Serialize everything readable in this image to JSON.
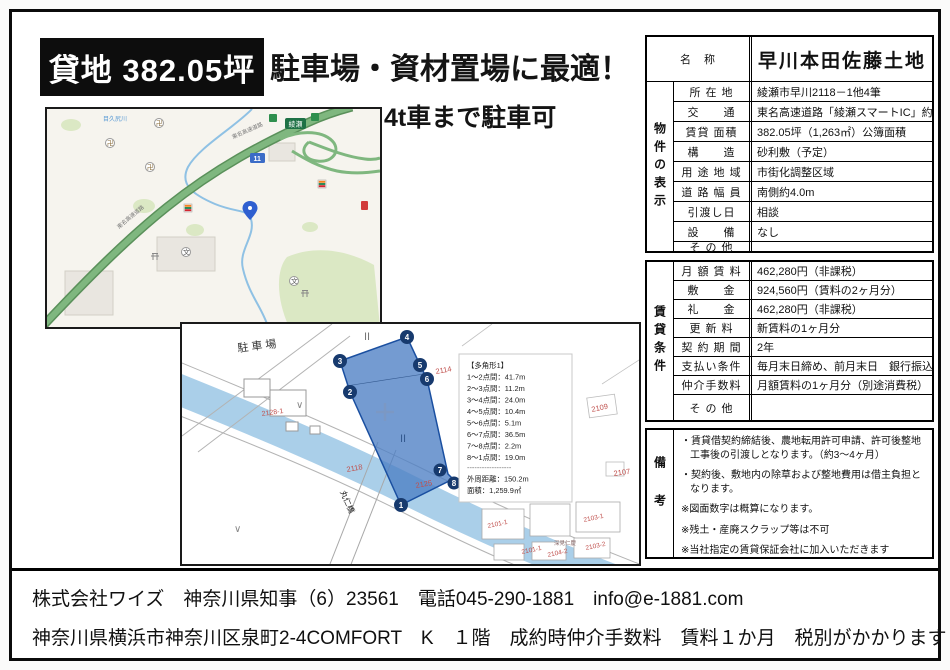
{
  "header": {
    "badge": "貸地 382.05坪",
    "headline": "駐車場・資材置場に最適！",
    "sub_headline": "4t車まで駐車可"
  },
  "property_table": {
    "name_label": "名　称",
    "name_value": "早川本田佐藤土地",
    "display": {
      "section_label": "物件の表示",
      "rows": [
        {
          "label": "所 在 地",
          "value": "綾瀬市早川2118－1他4筆"
        },
        {
          "label": "交　　通",
          "value": "東名高速道路「綾瀬スマートIC」約1km"
        },
        {
          "label": "賃貸 面積",
          "value": "382.05坪（1,263㎡）公簿面積"
        },
        {
          "label": "構　　造",
          "value": "砂利敷（予定）"
        },
        {
          "label": "用 途 地 域",
          "value": "市街化調整区域"
        },
        {
          "label": "道 路 幅 員",
          "value": "南側約4.0m"
        },
        {
          "label": "引渡し日",
          "value": "相談"
        },
        {
          "label": "設　　備",
          "value": "なし"
        },
        {
          "label": "そ の 他",
          "value": ""
        }
      ]
    },
    "lease": {
      "section_label": "賃貸条件",
      "rows": [
        {
          "label": "月 額 賃 料",
          "value": "462,280円（非課税）"
        },
        {
          "label": "敷　　金",
          "value": "924,560円（賃料の2ヶ月分）"
        },
        {
          "label": "礼　　金",
          "value": "462,280円（非課税）"
        },
        {
          "label": "更 新 料",
          "value": "新賃料の1ヶ月分"
        },
        {
          "label": "契 約 期 間",
          "value": "2年"
        },
        {
          "label": "支払い条件",
          "value": "毎月末日締め、前月末日　銀行振込"
        },
        {
          "label": "仲介手数料",
          "value": "月額賃料の1ヶ月分（別途消費税）"
        },
        {
          "label": "そ の 他",
          "value": ""
        }
      ]
    },
    "remarks": {
      "section_label": "備考",
      "items": [
        "・賃貸借契約締結後、農地転用許可申請、許可後整地工事後の引渡しとなります。（約3～4ヶ月）",
        "・契約後、敷地内の除草および整地費用は借主負担となります。",
        "※図面数字は概算になります。",
        "※残土・産廃スクラップ等は不可",
        "※当社指定の賃貸保証会社に加入いただきます"
      ]
    }
  },
  "road_map": {
    "expressway_label": "東名高速道路",
    "river_label": "目久尻川",
    "ic_sign_label": "綾瀬",
    "route_shield": "11",
    "temple_glyph": "卍",
    "school_glyph": "文"
  },
  "site_map": {
    "parking_label": "駐車場",
    "bridge_label": "丸仁橋",
    "field_mark": "II",
    "grass_mark": "∨",
    "parcel_labels": {
      "p2128_1": "2128-1",
      "p2114": "2114",
      "p2118": "2118",
      "p2109": "2109",
      "p2107": "2107",
      "p2125": "2125",
      "p2101_1a": "2101-1",
      "p2101_1b": "2101-1",
      "p2103_1": "2103-1",
      "p2103_2": "2103-2",
      "p2104_2": "2104-2",
      "p_owner": "深見仁慶"
    },
    "vertices": [
      "1",
      "2",
      "3",
      "4",
      "5",
      "6",
      "7",
      "8"
    ],
    "measurements": {
      "title": "【多角形1】",
      "lines": [
        "1～2点間：41.7m",
        "2～3点間：11.2m",
        "3～4点間：24.0m",
        "4～5点間：10.4m",
        "5～6点間：5.1m",
        "6～7点間：36.5m",
        "7～8点間：2.2m",
        "8～1点間：19.0m"
      ],
      "divider": "------------------",
      "perimeter": "外周距離：150.2m",
      "area": "面積：1,259.9㎡"
    },
    "colors": {
      "parcel_fill": "#4d7fc4",
      "parcel_stroke": "#1a4fa0",
      "river": "#aacfe9",
      "label_red": "#c0504d"
    }
  },
  "footer": {
    "line1": "株式会社ワイズ　神奈川県知事（6）23561　電話045-290-1881　info@e-1881.com",
    "line2": "神奈川県横浜市神奈川区泉町2-4COMFORT　K　１階　成約時仲介手数料　賃料１か月　税別がかかります"
  }
}
